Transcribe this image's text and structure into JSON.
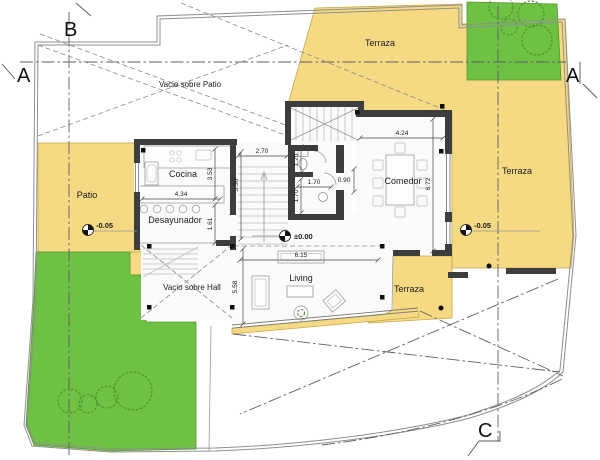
{
  "title": "Planta - plano de arquitectura",
  "colors": {
    "terrace": "#F5D983",
    "garden": "#6EC143",
    "wall": "#3D3D3D"
  },
  "sections": {
    "a_left": "A",
    "a_right": "A",
    "b": "B",
    "c": "C"
  },
  "rooms": {
    "cocina": "Cocina",
    "desayunador": "Desayunador",
    "comedor": "Comedor",
    "living": "Living",
    "patio": "Patio",
    "terraza_top": "Terraza",
    "terraza_right": "Terraza",
    "terraza_bottom": "Terraza",
    "vacio_patio": "Vacio sobre Patio",
    "vacio_hall": "Vacio sobre Hall"
  },
  "levels": {
    "main": "±0.00",
    "patio": "-0.05",
    "terrace": "-0.05"
  },
  "dimensions": {
    "hall_width": "2.70",
    "island": "4.34",
    "kitchen_depth": "3.53",
    "desayunador_depth": "1.61",
    "stair_depth": "3.30",
    "wc": "1.20",
    "bath_depth": "1.70",
    "bath_width": "1.70",
    "niche": "0.90",
    "comedor_width": "4.24",
    "comedor_depth": "6.72",
    "living_width": "6.15",
    "living_depth": "5.58"
  }
}
